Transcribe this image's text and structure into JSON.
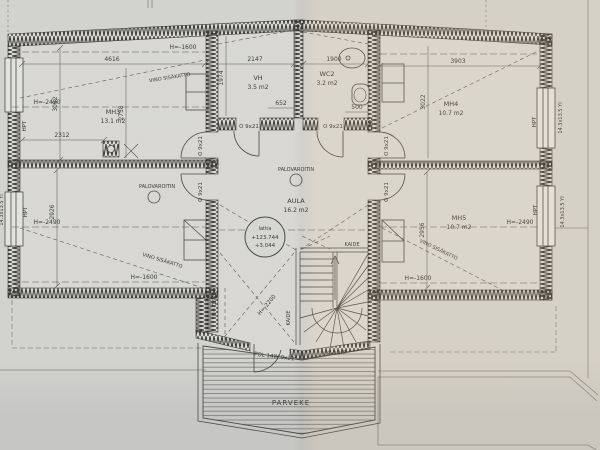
{
  "rooms": {
    "mh3": {
      "name": "MH3",
      "area": "13.1 m2"
    },
    "vh": {
      "name": "VH",
      "area": "3.5 m2"
    },
    "wc2": {
      "name": "WC2",
      "area": "3.2 m2"
    },
    "mh4": {
      "name": "MH4",
      "area": "10.7 m2"
    },
    "mh5": {
      "name": "MH5",
      "area": "10.7 m2"
    },
    "aula": {
      "name": "AULA",
      "area": "16.2 m2"
    },
    "parveke": {
      "name": "PARVEKE"
    }
  },
  "dimensions": {
    "mh3_width": "4616",
    "mh3_depth": "3052",
    "mh3_diag": "2758",
    "mh3_part": "2312",
    "vh_width": "2147",
    "vh_depth": "1974",
    "vh_offset": "652",
    "wc2_width": "1900",
    "wc2_offset": "500",
    "mh4_width": "3903",
    "mh4_depth": "3022",
    "mh5_depth": "2956",
    "lower_left_depth": "2926"
  },
  "heights": {
    "h_1600": "H=-1600",
    "h_2490": "H=-2490",
    "h_2200": "H=-2200",
    "h_1620": "H=-1620"
  },
  "annotations": {
    "sloped_ceiling": "VINO SISÄKATTO",
    "smoke_detector": "PALOVAROITIN",
    "railing": "KAIDE",
    "window_mark": "HPT",
    "door_size": "O 9x21",
    "balcony_door": "POL 14W 9x21",
    "balcony_door_size": "5.5x13.5",
    "window_spec": "14.3x13.5 YI"
  },
  "level_marker": {
    "label": "lattia",
    "elevation": "+123.744",
    "relative": "+3.044"
  }
}
